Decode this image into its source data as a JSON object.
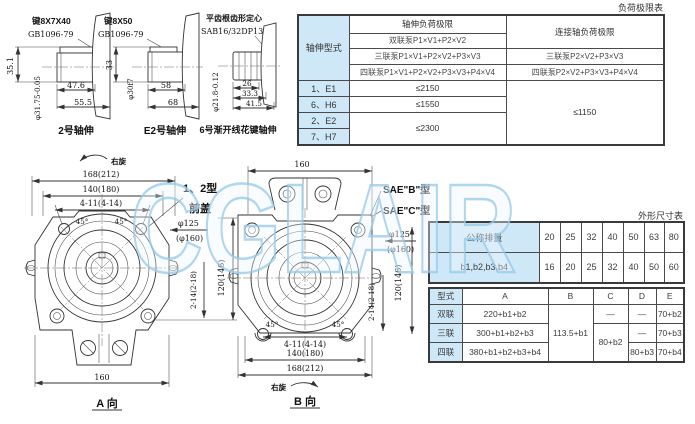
{
  "watermark": "CGLAIR",
  "titles": {
    "load_table": "负荷极限表",
    "dim_table": "外形尺寸表"
  },
  "shafts": [
    {
      "key_label": "键8X7X40",
      "std_label": "GB1096-79",
      "dim_v": "35.1",
      "dia": "φ31.75-0.05",
      "len1": "47.6",
      "len2": "55.5",
      "caption": "2号轴伸"
    },
    {
      "key_label": "键8X50",
      "std_label": "GB1096-79",
      "dim_v": "33",
      "dia": "φ30f7",
      "len1": "58",
      "len2": "68",
      "caption": "E2号轴伸"
    },
    {
      "key_label": "平齿根齿形定心",
      "std_label": "SAB16/32DP13齿",
      "dia": "φ21.8-0.12",
      "len1": "26",
      "len2": "33.3",
      "len3": "41.5",
      "caption": "6号渐开线花键轴伸"
    }
  ],
  "load_table": {
    "corner": "轴伸型式",
    "col_shaft": "轴伸负荷极限",
    "col_joint": "连接轴负荷极限",
    "f_double": "双联泵P1×V1+P2×V2",
    "f_triple": "三联泵P1×V1+P2×V2+P3×V3",
    "f_quad": "四联泵P1×V1+P2×V2+P3×V3+P4×V4",
    "f_triple_r": "三联泵P2×V2+P3×V3",
    "f_quad_r": "四联泵P2×V2+P3×V3+P4×V4",
    "t1": "1、E1",
    "v1": "≤2150",
    "t2": "6、H6",
    "v2": "≤1550",
    "t3": "2、E2",
    "v34": "≤2300",
    "t4": "7、H7",
    "vr": "≤1150"
  },
  "dim_table": {
    "row1_label": "公称排量",
    "row1": [
      "20",
      "25",
      "32",
      "40",
      "50",
      "63",
      "80"
    ],
    "row2_label": "b1,b2,b3,b4",
    "row2": [
      "16",
      "20",
      "25",
      "32",
      "40",
      "50",
      "60"
    ]
  },
  "type_table": {
    "h": [
      "型式",
      "A",
      "B",
      "C",
      "D",
      "E"
    ],
    "b_all": "113.5+b1",
    "c_23": "80+b2",
    "r1": {
      "t": "双联",
      "a": "220+b1+b2",
      "c": "—",
      "d": "—",
      "e": "70+b2"
    },
    "r2": {
      "t": "三联",
      "a": "300+b1+b2+b3",
      "d": "—",
      "e": "70+b3"
    },
    "r3": {
      "t": "四联",
      "a": "380+b1+b2+b3+b4",
      "d": "80+b3",
      "e": "70+b4"
    }
  },
  "view_a": {
    "rotation": "右旋",
    "d168": "168(212)",
    "d140": "140(180)",
    "d411": "4-11(4-14)",
    "a45l": "45°",
    "a45r": "45°",
    "callout1": "1、2型",
    "callout2": "前盖",
    "d125": "φ125",
    "d160p": "(φ160)",
    "d120": "120(146)",
    "d214": "2-14(2-18)",
    "d160": "160",
    "caption": "A 向"
  },
  "view_b": {
    "d160": "160",
    "callout1": "SAE\"B\"型",
    "callout2": "SAE\"C\"型",
    "d125": "φ125",
    "d160p": "(φ160)",
    "d120": "120(146)",
    "d214": "2-14(2-18)",
    "a45l": "45°",
    "a45r": "45°",
    "d411": "4-11(4-14)",
    "d140": "140(180)",
    "d168": "168(212)",
    "rotation": "右旋",
    "caption": "B 向"
  }
}
